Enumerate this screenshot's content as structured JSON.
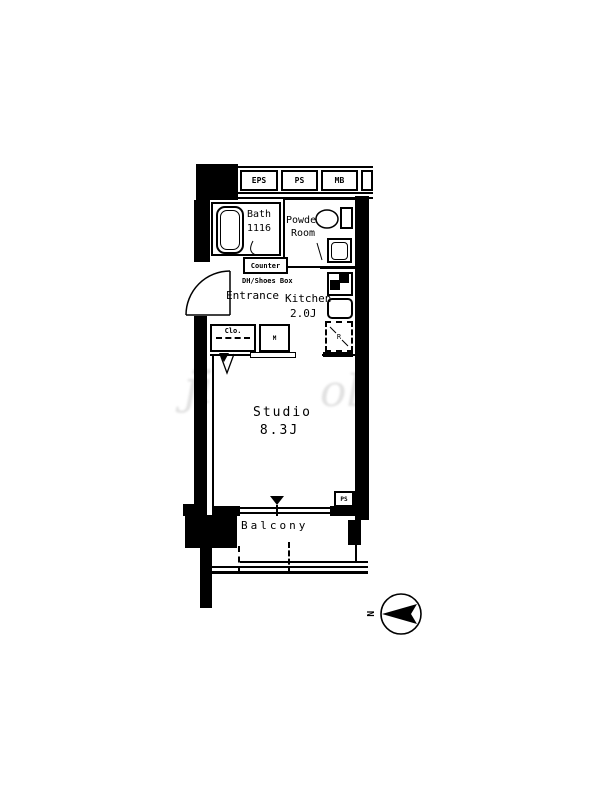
{
  "colors": {
    "ink": "#000000",
    "paper": "#ffffff",
    "watermark": "#dadada"
  },
  "corridor": {
    "shafts": [
      "EPS",
      "PS",
      "MB"
    ]
  },
  "rooms": {
    "bath": {
      "name": "Bath",
      "size": "1116"
    },
    "powder_room": {
      "line1": "Powder",
      "line2": "Room"
    },
    "entrance": {
      "name": "Entrance"
    },
    "kitchen": {
      "name": "Kitchen",
      "size": "2.0J"
    },
    "studio": {
      "name": "Studio",
      "size": "8.3J"
    },
    "balcony": {
      "name": "Balcony"
    }
  },
  "fixtures": {
    "counter": "Counter",
    "shoes_box": "DH/Shoes Box",
    "closet": "Clo.",
    "meter_box": "M",
    "refrigerator": "R",
    "pipe_shaft": "PS"
  },
  "compass": {
    "north": "N"
  },
  "watermark": {
    "left": "ji",
    "right": "ol"
  }
}
